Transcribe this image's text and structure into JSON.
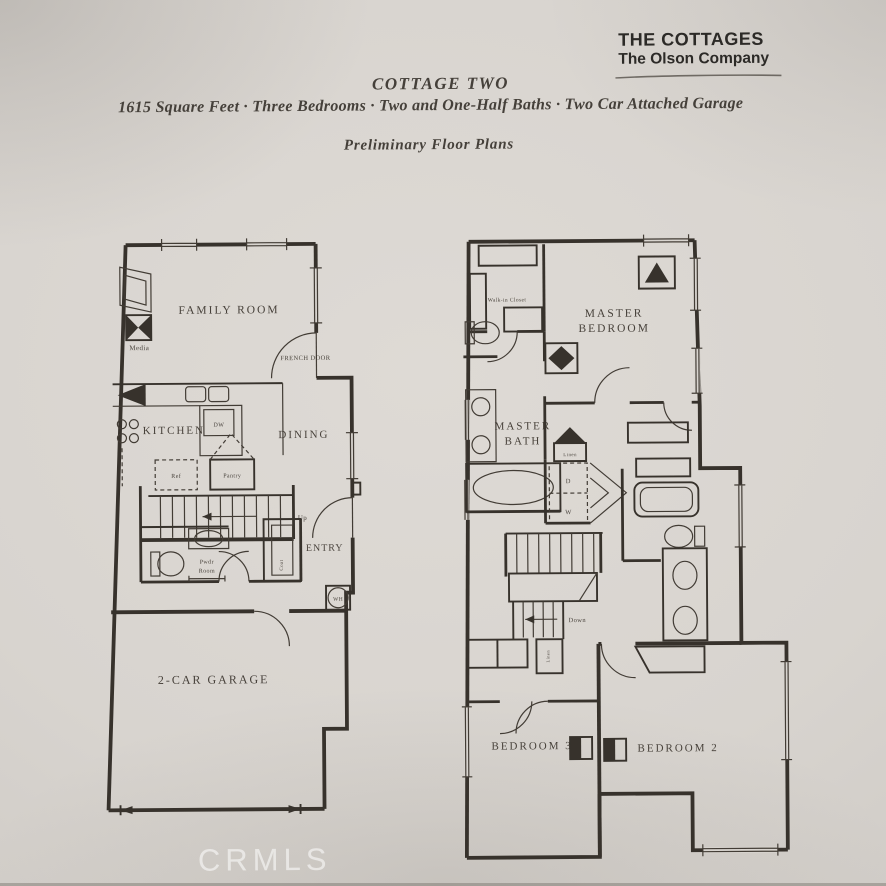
{
  "brand": {
    "name": "THE COTTAGES",
    "company": "The Olson Company"
  },
  "header": {
    "plan_name": "COTTAGE TWO",
    "specs": "1615 Square Feet · Three Bedrooms  · Two and One-Half Baths · Two Car Attached Garage",
    "note": "Preliminary Floor Plans"
  },
  "first_floor": {
    "family_room": "FAMILY ROOM",
    "media": "Media",
    "kitchen": "KITCHEN",
    "dishwasher": "DW",
    "refrigerator": "Ref",
    "pantry": "Pantry",
    "dining": "DINING",
    "french_door": "FRENCH DOOR",
    "up": "Up",
    "powder_line1": "Pwdr",
    "powder_line2": "Room",
    "coat": "Coat",
    "entry": "ENTRY",
    "water_heater": "WH",
    "garage": "2-CAR GARAGE"
  },
  "second_floor": {
    "walk_in_closet": "Walk-in Closet",
    "master_bedroom_line1": "MASTER",
    "master_bedroom_line2": "BEDROOM",
    "master_bath_line1": "MASTER",
    "master_bath_line2": "BATH",
    "linen_upper": "Linen",
    "dryer": "D",
    "washer": "W",
    "down": "Down",
    "linen_lower": "Linen",
    "bedroom3": "BEDROOM 3",
    "bedroom2": "BEDROOM 2"
  },
  "watermark": "CRMLS",
  "colors": {
    "paper": "#d8d4cf",
    "ink": "#37322c",
    "watermark": "rgba(255,255,255,0.55)"
  }
}
